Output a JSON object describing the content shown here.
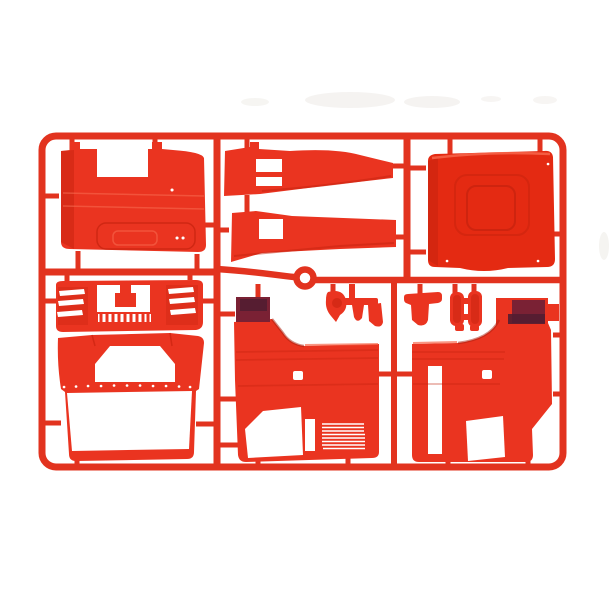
{
  "scene": {
    "description": "Bright red injection-molded model kit sprue (parts tree) holding truck cab body panels, photographed on a plain white background",
    "background_color": "#ffffff"
  },
  "colors": {
    "white": "#ffffff",
    "sprue_red": "#e2331f",
    "part_red": "#ea3420",
    "panel_red": "#e42a12",
    "shadow_red": "#c4220e",
    "deep_red": "#a81c0b",
    "highlight_red": "#f7694f",
    "maroon": "#7a2134",
    "maroon_dark": "#521d31",
    "smudge_gray": "#f3f1ee"
  },
  "parts": {
    "frame_label": "sprue-frame",
    "labels": [
      "roof panel",
      "upper side sill strip",
      "lower side sill strip",
      "rear cab panel with sunroof recess",
      "front grille panel with louvers",
      "front panel with windshield opening",
      "left cab side panel with wheel arch",
      "right cab side panel with wheel arch",
      "mirror housing",
      "small bracket with tabs",
      "air deflector bracket",
      "twin hinge blocks",
      "injection gate ring"
    ]
  }
}
